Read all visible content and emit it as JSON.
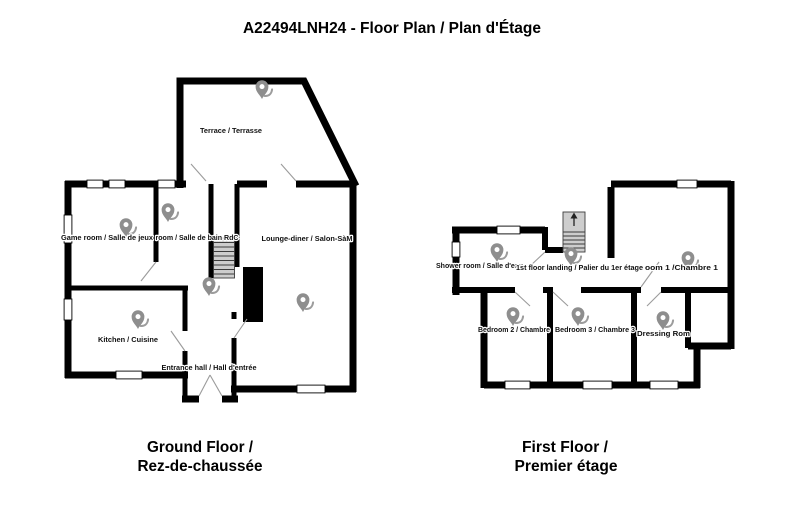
{
  "title": "A22494LNH24 - Floor Plan / Plan d'Étage",
  "ground_floor": {
    "caption_line1": "Ground Floor /",
    "caption_line2": "Rez-de-chaussée",
    "rooms": {
      "terrace": "Terrace / Terrasse",
      "game_room": "Game room / Salle de jeux",
      "bathroom_rdc": "room / Salle de bain RdC",
      "lounge_diner": "Lounge-diner / Salon-SàM",
      "kitchen": "Kitchen / Cuisine",
      "entrance_hall": "Entrance hall / Hall d'entrée"
    }
  },
  "first_floor": {
    "caption_line1": "First Floor /",
    "caption_line2": "Premier étage",
    "rooms": {
      "shower_room": "Shower room / Salle d'eau",
      "landing": "1st floor landing / Palier du 1er étage",
      "bedroom_1": "oom 1 /Chambre 1",
      "bedroom_2": "Bedroom 2 / Chambre",
      "bedroom_3": "Bedroom 3 / Chambre 3",
      "dressing_room": "Dressing Rom"
    }
  },
  "icons": {
    "pin": "location-pin",
    "stairs_direction": "up-arrow"
  },
  "colors": {
    "walls": "#000000",
    "pin": "#8e8e8e",
    "stair_fill": "#cdcdcd",
    "background": "#ffffff",
    "text": "#000000"
  }
}
